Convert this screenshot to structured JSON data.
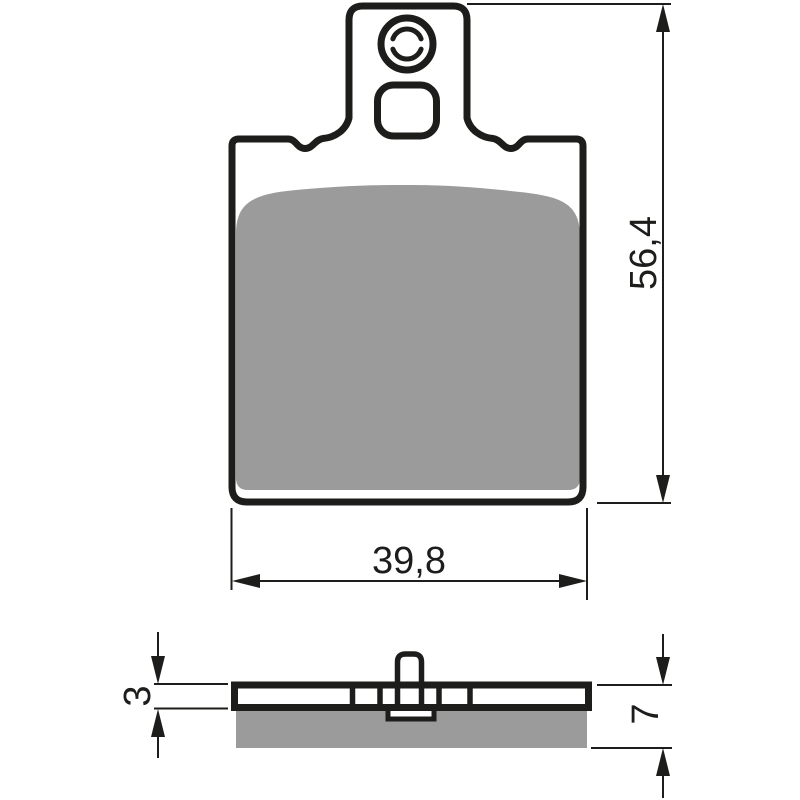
{
  "figure": {
    "type": "technical-drawing",
    "subject": "brake pad with backing plate, friction material, mounting tab and holes",
    "colors": {
      "outline": "#1d1d1b",
      "friction_material": "#9b9b9b",
      "background": "#ffffff",
      "dimension_line": "#1d1d1b"
    },
    "views": {
      "front": "front view of brake pad",
      "side": "side profile of brake pad"
    },
    "dimensions": {
      "overall_height": "56,4",
      "overall_width": "39,8",
      "backing_plate_thickness": "3",
      "total_thickness": "7"
    }
  }
}
